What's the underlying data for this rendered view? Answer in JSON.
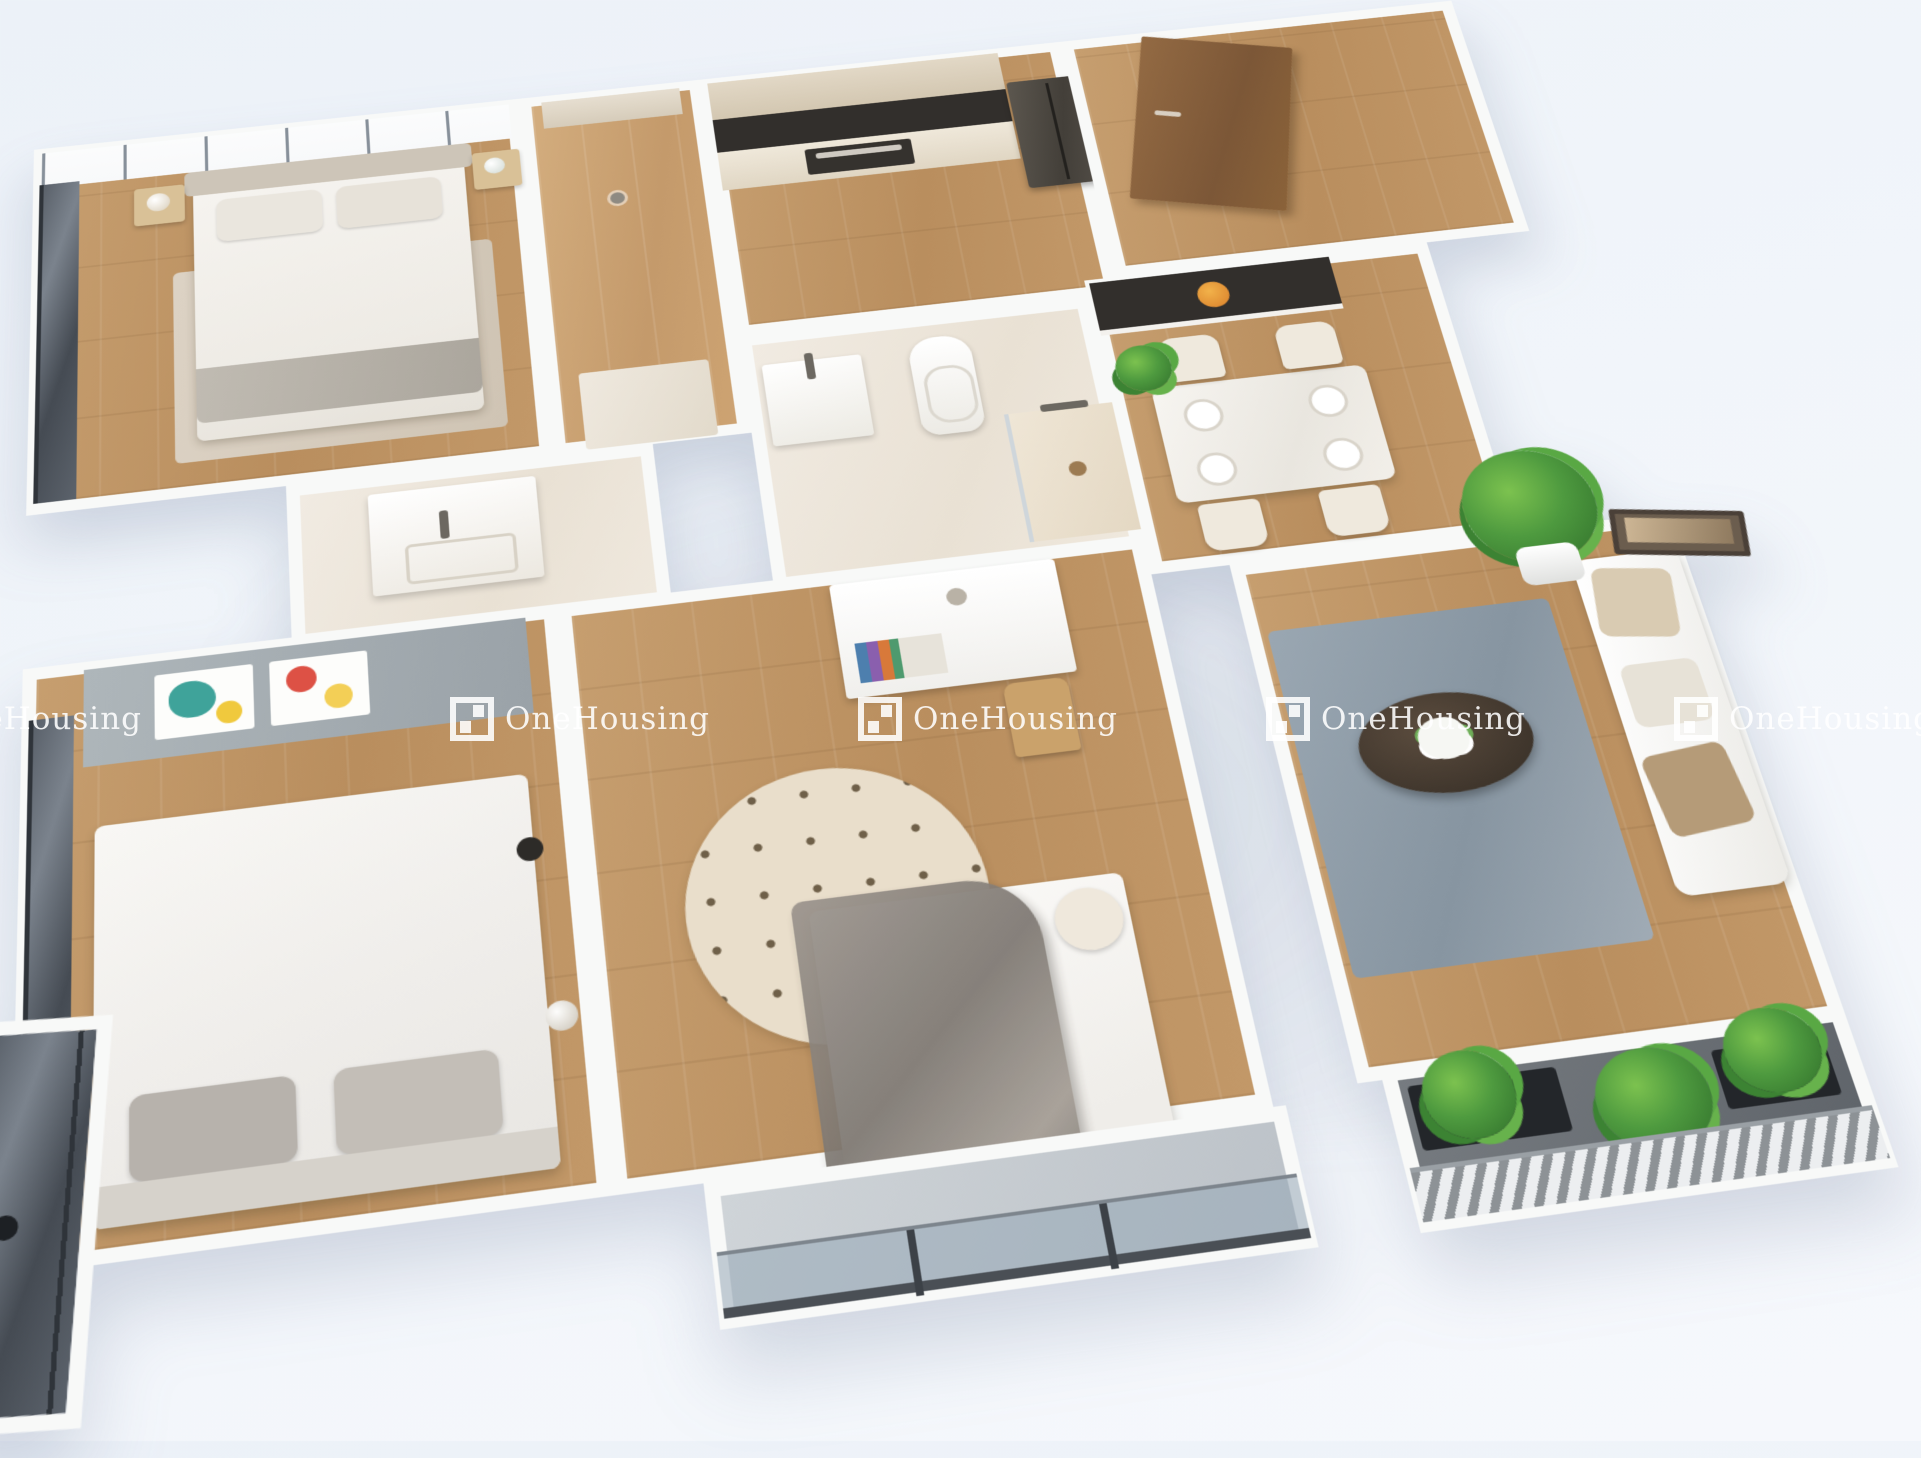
{
  "scene": {
    "type": "3d-apartment-floor-plan-render",
    "rooms": [
      "master-bedroom",
      "wardrobe-hall",
      "kitchen",
      "entry-hall",
      "master-bathroom",
      "second-bathroom",
      "dining-area",
      "living-room",
      "second-bedroom",
      "kids-bedroom",
      "center-balcony",
      "right-balcony",
      "left-dark-balcony"
    ]
  },
  "watermark": {
    "text": "OneHousing",
    "logo_icon": "onehousing-window-logo",
    "color": "#ffffff"
  },
  "palette": {
    "page_background": "#eef2f9",
    "wall_white": "#f8f9f8",
    "wood_floor": "#bf9569",
    "tile_floor": "#ece4d8",
    "dark_glass": "#565d66",
    "dark_marble": "#322f2c",
    "rug_gray_blue": "#93a0ab",
    "plant_green": "#4e9a3f",
    "door_wood": "#8a6239",
    "canopy_gray": "#8b8681"
  }
}
